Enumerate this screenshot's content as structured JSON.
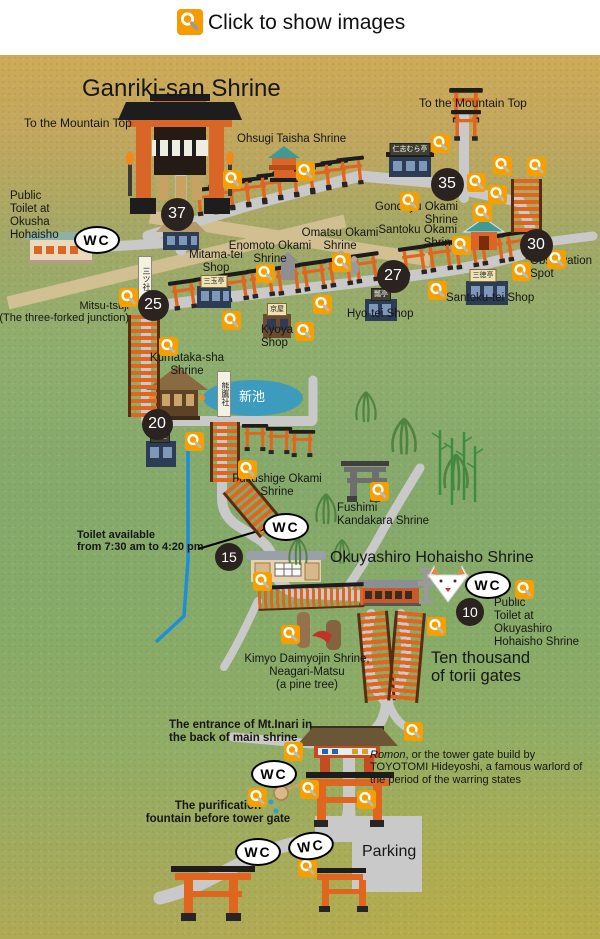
{
  "header": {
    "label": "Click to show images"
  },
  "wc_label": "WC",
  "colors": {
    "marker_orange": "#f59b00",
    "badge_dark": "#2b2320",
    "road_gray": "#c9c9c9",
    "pond_blue": "#3d9cbd",
    "torii_orange": "#e0651f"
  },
  "badges": [
    {
      "n": "37",
      "x": 177,
      "y": 214,
      "s": 33
    },
    {
      "n": "35",
      "x": 447,
      "y": 184,
      "s": 33
    },
    {
      "n": "30",
      "x": 536,
      "y": 245,
      "s": 33
    },
    {
      "n": "27",
      "x": 393,
      "y": 276,
      "s": 33
    },
    {
      "n": "25",
      "x": 153,
      "y": 305,
      "s": 31
    },
    {
      "n": "20",
      "x": 157,
      "y": 424,
      "s": 31
    },
    {
      "n": "15",
      "x": 229,
      "y": 557,
      "s": 28
    },
    {
      "n": "10",
      "x": 470,
      "y": 612,
      "s": 28
    }
  ],
  "wc": [
    {
      "x": 97,
      "y": 240
    },
    {
      "x": 286,
      "y": 527
    },
    {
      "x": 488,
      "y": 585
    },
    {
      "x": 274,
      "y": 774
    },
    {
      "x": 258,
      "y": 852
    },
    {
      "x": 311,
      "y": 846,
      "r": -8
    }
  ],
  "markers": [
    [
      232,
      179
    ],
    [
      305,
      171
    ],
    [
      440,
      143
    ],
    [
      502,
      165
    ],
    [
      536,
      166
    ],
    [
      476,
      182
    ],
    [
      497,
      194
    ],
    [
      482,
      212
    ],
    [
      409,
      201
    ],
    [
      461,
      245
    ],
    [
      556,
      259
    ],
    [
      521,
      271
    ],
    [
      341,
      262
    ],
    [
      265,
      273
    ],
    [
      128,
      297
    ],
    [
      231,
      320
    ],
    [
      168,
      346
    ],
    [
      304,
      331
    ],
    [
      322,
      304
    ],
    [
      437,
      290
    ],
    [
      194,
      441
    ],
    [
      247,
      469
    ],
    [
      379,
      491
    ],
    [
      262,
      581
    ],
    [
      524,
      589
    ],
    [
      436,
      626
    ],
    [
      290,
      634
    ],
    [
      413,
      731
    ],
    [
      293,
      751
    ],
    [
      257,
      797
    ],
    [
      309,
      789
    ],
    [
      366,
      799
    ],
    [
      307,
      867
    ]
  ],
  "labels": [
    {
      "n": "title-ganriki",
      "t": "Ganriki-san Shrine",
      "x": 82,
      "y": 76,
      "s": 24
    },
    {
      "n": "to-mountain-top-left",
      "t": "To the Mountain Top",
      "x": 24,
      "y": 117,
      "s": 12
    },
    {
      "n": "to-mountain-top-right",
      "t": "To the Mountain Top",
      "x": 419,
      "y": 97,
      "s": 12
    },
    {
      "n": "ohsugi-taisha-shrine",
      "t": "Ohsugi Taisha Shrine",
      "x": 237,
      "y": 133,
      "s": 11.5
    },
    {
      "n": "public-toilet-okusha",
      "t": "Public\nToilet at\nOkusha\nHohaisho",
      "x": 10,
      "y": 190,
      "s": 11.5
    },
    {
      "n": "gondayu-okami-shrine",
      "t": "Gondayu Okami\nShrine",
      "x": 458,
      "y": 201,
      "s": 11.5,
      "a": "right"
    },
    {
      "n": "santoku-okami-shrine",
      "t": "Santoku Okami\nShrine",
      "x": 457,
      "y": 224,
      "s": 11.5,
      "a": "right"
    },
    {
      "n": "omatsu-okami-shrine",
      "t": "Omatsu Okami\nShrine",
      "x": 340,
      "y": 227,
      "s": 11.5,
      "a": "center"
    },
    {
      "n": "enomoto-okami-shrine",
      "t": "Enomoto Okami\nShrine",
      "x": 270,
      "y": 240,
      "s": 11.5,
      "a": "center"
    },
    {
      "n": "mitama-tei-shop",
      "t": "Mitama-tei\nShop",
      "x": 216,
      "y": 249,
      "s": 11.5,
      "a": "center"
    },
    {
      "n": "observation-spot",
      "t": "Observation\nSpot",
      "x": 530,
      "y": 255,
      "s": 11.5
    },
    {
      "n": "mitsu-tsuji",
      "t": "Mitsu-tsuji\n(The three-forked junction)",
      "x": 129,
      "y": 300,
      "s": 11,
      "a": "right"
    },
    {
      "n": "santoku-tei-shop",
      "t": "Santoku-tei Shop",
      "x": 446,
      "y": 292,
      "s": 11.5
    },
    {
      "n": "hyo-tei-shop",
      "t": "Hyo-tei Shop",
      "x": 347,
      "y": 308,
      "s": 11.5
    },
    {
      "n": "kyoya-shop",
      "t": "Kyoya\nShop",
      "x": 261,
      "y": 324,
      "s": 11.5
    },
    {
      "n": "kumataka-sha-shrine",
      "t": "Kumataka-sha\nShrine",
      "x": 187,
      "y": 352,
      "s": 11.5,
      "a": "center"
    },
    {
      "n": "shin-ike-pond-name",
      "t": "新池",
      "x": 252,
      "y": 390,
      "s": 13,
      "c": "#ffffff",
      "a": "center"
    },
    {
      "n": "fukushige-okami-shrine",
      "t": "Fukushige Okami\nShrine",
      "x": 277,
      "y": 473,
      "s": 11.5,
      "a": "center"
    },
    {
      "n": "fushimi-kandakara-shrine",
      "t": "Fushimi\nKandakara Shrine",
      "x": 337,
      "y": 502,
      "s": 11.5
    },
    {
      "n": "toilet-hours",
      "t": "Toilet available\nfrom 7:30 am to 4:20 pm",
      "x": 77,
      "y": 529,
      "s": 11,
      "b": 1
    },
    {
      "n": "okuyashiro-title",
      "t": "Okuyashiro Hohaisho Shrine",
      "x": 330,
      "y": 549,
      "s": 16
    },
    {
      "n": "public-toilet-okuyashiro",
      "t": "Public\nToilet at\nOkuyashiro\nHohaisho Shrine",
      "x": 494,
      "y": 597,
      "s": 11.5
    },
    {
      "n": "ten-thousand-torii",
      "t": "Ten thousand\nof torii gates",
      "x": 431,
      "y": 649,
      "s": 16.5
    },
    {
      "n": "kimyo-daimyojin",
      "t": "Kimyo Daimyojin Shrine,\nNeagari-Matsu\n(a pine tree)",
      "x": 307,
      "y": 653,
      "s": 11.5,
      "a": "center"
    },
    {
      "n": "entrance-mt-inari",
      "t": "The entrance of Mt.Inari in\nthe back of main shrine",
      "x": 169,
      "y": 719,
      "s": 11.5,
      "b": 1
    },
    {
      "n": "romon-note",
      "parts": [
        {
          "t": "Romon",
          "i": 1
        },
        {
          "t": ", or the tower gate build by TOYOTOMI Hideyoshi, a famous warlord of the period of the warring states"
        }
      ],
      "x": 370,
      "y": 749,
      "s": 11,
      "w": 224
    },
    {
      "n": "purification-fountain",
      "t": "The purification\nfountain before tower gate",
      "x": 218,
      "y": 800,
      "s": 11.5,
      "b": 1,
      "a": "center"
    },
    {
      "n": "parking",
      "t": "Parking",
      "x": 362,
      "y": 843,
      "s": 16
    }
  ],
  "signs": [
    {
      "t": "仁志むら亭",
      "x": 410,
      "y": 143,
      "v": "dark"
    },
    {
      "t": "三玉亭",
      "x": 214,
      "y": 275,
      "v": "light"
    },
    {
      "t": "三徳亭",
      "x": 483,
      "y": 269,
      "v": "light"
    },
    {
      "t": "瓢亭",
      "x": 381,
      "y": 288,
      "v": "dark"
    },
    {
      "t": "京屋",
      "x": 277,
      "y": 303,
      "v": "light"
    },
    {
      "t": "竹屋",
      "x": 160,
      "y": 430,
      "v": "dark"
    },
    {
      "t": "三ツ社",
      "x": 145,
      "y": 256,
      "v": "vert"
    },
    {
      "t": "熊鷹社",
      "x": 224,
      "y": 371,
      "v": "vert"
    }
  ]
}
